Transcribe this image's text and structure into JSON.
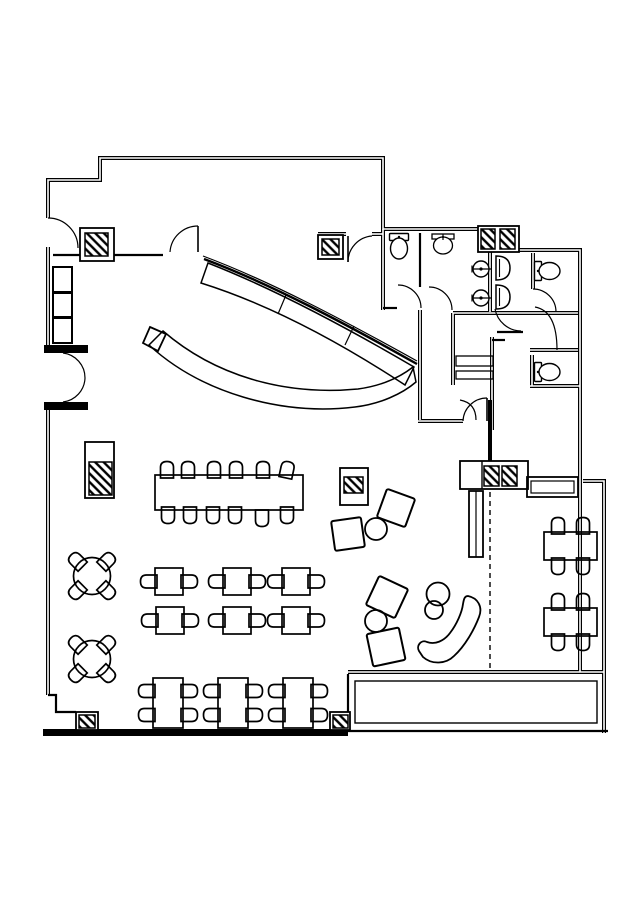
{
  "canvas": {
    "w": 636,
    "h": 900,
    "bg": "#ffffff",
    "ink": "#000000"
  },
  "walls": {
    "double": [
      "M48,218 L48,180 L100,180 L100,158 L383,158 L383,229 L478,229",
      "M517,250 L580,250 L580,672",
      "M583,481 L604,481 L604,733",
      "M348,672 L604,672",
      "M48,247 L48,345",
      "M48,410 L48,695",
      "M420,310 L420,420",
      "M453,313 L453,385",
      "M418,421 L463,421",
      "M492,337 L492,430",
      "M453,313 L578,313",
      "M530,350 L578,350",
      "M530,386 L580,386",
      "M533,253 L533,289",
      "M383,229 L383,310",
      "M318,234 L346,234",
      "M372,234 L383,234",
      "M532,355 L532,386",
      "M490,250 L490,312"
    ],
    "medium": [
      "M420,233 L420,287",
      "M383,308 L397,308",
      "M497,332 L523,332",
      "M53,255 L80,255",
      "M114,255 L163,255",
      "M48,695 L56,695 L56,712 L76,712",
      "M348,674 L348,712",
      "M331,731 L608,731",
      "M492,340 L505,340"
    ],
    "black_rects": [
      [
        43,
        729,
        305,
        7
      ],
      [
        44,
        345,
        44,
        8
      ],
      [
        44,
        402,
        44,
        8
      ],
      [
        488,
        400,
        4,
        62
      ],
      [
        495,
        226,
        4,
        26
      ],
      [
        499,
        461,
        3,
        28
      ]
    ],
    "dashed": [
      "M490,492 L490,670"
    ]
  },
  "doors": {
    "arcs": [
      "M48,218 A30,30 0 0 1 78,248",
      "M63,353 A25,25 0 0 1 85,378",
      "M63,402 A25,25 0 0 0 85,378",
      "M198,226 A28,28 0 0 0 170,252",
      "M348,262 A26,26 0 0 1 372,236",
      "M398,285 A23,23 0 0 1 421,308",
      "M429,287 A23,23 0 0 1 452,310",
      "M533,289 A23,23 0 0 1 556,312",
      "M535,307 Q557,311 557,350",
      "M495,309 A27,27 0 0 0 521,331",
      "M463,421 A24,24 0 0 1 487,398",
      "M460,400 Q476,403 476,420"
    ],
    "leaves": [
      "M198,226 L198,252",
      "M348,236 L348,262",
      "M487,398 L487,421"
    ]
  },
  "columns": [
    {
      "box": [
        80,
        228,
        34,
        33
      ],
      "hatch": [
        85,
        233,
        23,
        23
      ]
    },
    {
      "box": [
        318,
        235,
        25,
        24
      ],
      "hatch": [
        322,
        239,
        17,
        16
      ]
    },
    {
      "box": [
        478,
        226,
        41,
        26
      ],
      "hatch": [
        481,
        229,
        14,
        20
      ],
      "hatch2": [
        500,
        229,
        15,
        20
      ]
    },
    {
      "box": [
        85,
        442,
        29,
        56
      ],
      "hatch": [
        89,
        462,
        23,
        33
      ]
    },
    {
      "box": [
        340,
        468,
        28,
        37
      ],
      "hatch": [
        344,
        477,
        19,
        16
      ]
    },
    {
      "box": [
        460,
        461,
        68,
        28
      ],
      "hatch": [
        484,
        466,
        15,
        20
      ],
      "hatch2": [
        502,
        466,
        15,
        20
      ],
      "divider": 482
    },
    {
      "box": [
        76,
        712,
        22,
        18
      ],
      "hatch": [
        79,
        715,
        16,
        13
      ]
    },
    {
      "box": [
        330,
        712,
        20,
        18
      ],
      "hatch": [
        333,
        715,
        15,
        13
      ]
    }
  ],
  "boxes": [
    {
      "r": [
        53,
        267,
        19,
        25
      ],
      "sw": 2,
      "name": "booth-seat"
    },
    {
      "r": [
        53,
        293,
        19,
        24
      ],
      "sw": 2,
      "name": "booth-seat"
    },
    {
      "r": [
        53,
        318,
        19,
        25
      ],
      "sw": 2,
      "name": "booth-seat"
    },
    {
      "r": [
        456,
        356,
        37,
        10
      ],
      "sw": 1.3,
      "name": "shelf"
    },
    {
      "r": [
        456,
        371,
        37,
        8
      ],
      "sw": 1.3,
      "name": "shelf"
    },
    {
      "r": [
        355,
        681,
        242,
        42
      ],
      "sw": 1.4,
      "name": "terrace-planter"
    },
    {
      "r": [
        527,
        477,
        51,
        20
      ],
      "sw": 1.8,
      "name": "banquette-bench"
    },
    {
      "r": [
        531,
        481,
        43,
        12
      ],
      "sw": 1.2,
      "name": "banquette-bench-inner"
    },
    {
      "r": [
        469,
        491,
        14,
        66
      ],
      "sw": 1.8,
      "name": "wall-pier"
    }
  ],
  "lines": [
    {
      "d": "M476,491 L476,557",
      "sw": 1.2,
      "name": "wall-pier-line"
    }
  ],
  "bar": {
    "thin": [
      "M203,256 C270,281 345,321 417,361",
      "M204,259 C271,284 346,324 417,364"
    ],
    "counter": "M208,263 C272,288 344,326 414,367 L405,385 C338,341 268,304 201,283 Z",
    "dividers": [
      "M286,295 L278,314",
      "M354,326 L345,345"
    ],
    "crescent": "M149,345 C200,392 280,416 355,407 C380,404 402,394 416,382 L413,367 C399,378 380,386 358,389 C283,396 214,375 163,331 Z",
    "cap": "M150,327 L166,334 L158,351 L143,343 Z"
  },
  "lounge": {
    "squares": [
      {
        "c": [
          396,
          508
        ],
        "s": 30,
        "r": 20
      },
      {
        "c": [
          348,
          534
        ],
        "s": 30,
        "r": -8
      },
      {
        "c": [
          387,
          597
        ],
        "s": 32,
        "r": 25
      },
      {
        "c": [
          386,
          647
        ],
        "s": 33,
        "r": -12
      }
    ],
    "circles": [
      [
        376,
        529,
        11
      ],
      [
        376,
        621,
        11
      ],
      [
        438,
        594,
        11.5
      ],
      [
        434,
        610,
        9
      ]
    ],
    "bench": "M468,596 C478,598 483,607 479,617 C474,630 465,646 454,656 C446,664 432,665 423,657 L419,651 C416,646 421,639 427,642 C435,645 444,641 450,633 C457,624 462,612 463,604 C464,598 465,596 468,596 Z"
  },
  "fixtures": {
    "toilets": [
      {
        "c": [
          399,
          250
        ],
        "r": 0
      },
      {
        "c": [
          551,
          271
        ],
        "r": -90
      },
      {
        "c": [
          551,
          372
        ],
        "r": -90
      }
    ],
    "sinks": [
      {
        "c": [
          443,
          243
        ]
      }
    ],
    "basins": [
      [
        482,
        269
      ],
      [
        482,
        298
      ]
    ],
    "urinals": [
      [
        496,
        268
      ],
      [
        496,
        297
      ]
    ]
  },
  "furniture": {
    "banquet": {
      "rect": [
        155,
        475,
        148,
        35
      ],
      "top_y": 470,
      "top_xs": [
        167,
        188,
        214,
        236,
        263,
        287
      ],
      "bottom_y": 515,
      "bottom_xs": [
        168,
        190,
        213,
        235,
        262,
        287
      ]
    },
    "two_top": {
      "size": [
        28,
        27
      ],
      "pos": [
        [
          155,
          568
        ],
        [
          223,
          568
        ],
        [
          282,
          568
        ],
        [
          156,
          607
        ],
        [
          223,
          607
        ],
        [
          282,
          607
        ]
      ]
    },
    "four_top_v": {
      "size": [
        30,
        50
      ],
      "pos": [
        [
          153,
          678
        ],
        [
          218,
          678
        ],
        [
          283,
          678
        ]
      ]
    },
    "four_top_h": {
      "size": [
        53,
        28
      ],
      "pos": [
        [
          544,
          532
        ],
        [
          544,
          608
        ]
      ]
    },
    "round_tables": {
      "radius": 18.5,
      "chair_offset": 15,
      "pos": [
        [
          92,
          576
        ],
        [
          92,
          659
        ]
      ]
    }
  }
}
